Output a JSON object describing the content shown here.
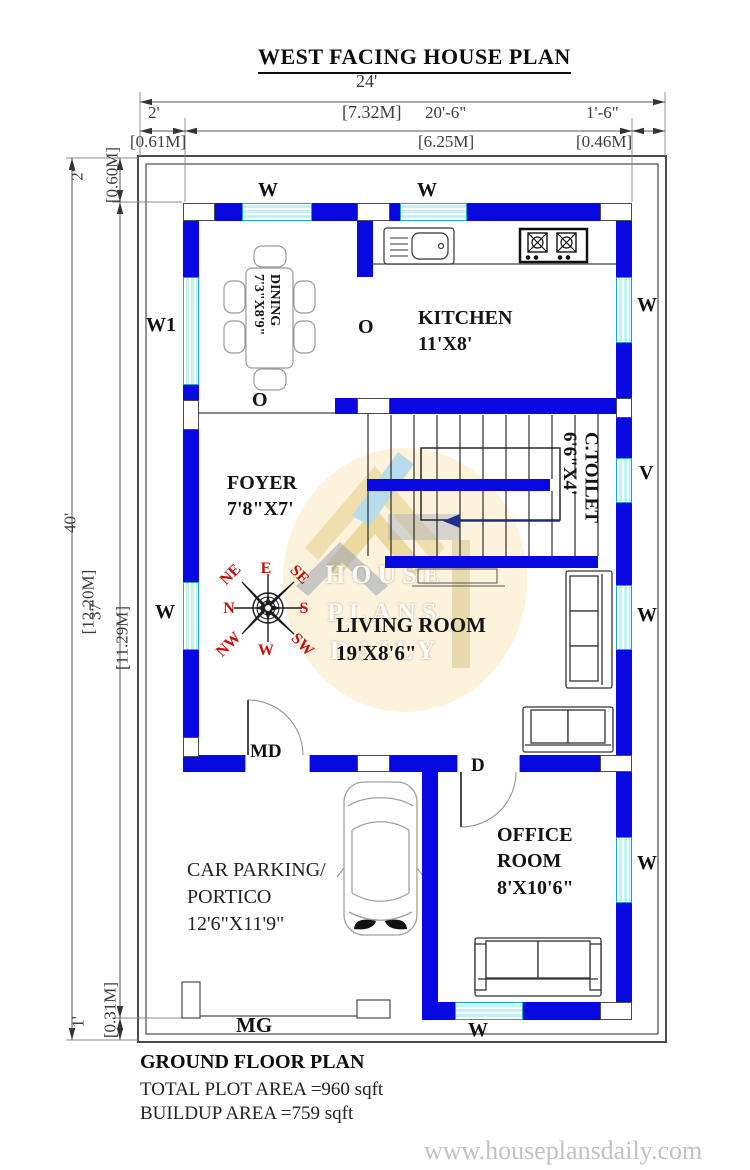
{
  "title": "WEST FACING HOUSE PLAN",
  "dimensions": {
    "top": {
      "overall_ft": "24'",
      "overall_m": "[7.32M]",
      "left_ft": "2'",
      "left_m": "[0.61M]",
      "mid_ft": "20'-6\"",
      "mid_m": "[6.25M]",
      "right_ft": "1'-6\"",
      "right_m": "[0.46M]"
    },
    "left": {
      "overall_ft": "40'",
      "overall_m": "[12.20M]",
      "top_ft": "2'",
      "top_m": "[0.60M]",
      "mid_ft": "37'",
      "mid_m": "[11.29M]",
      "bottom_ft": "1'",
      "bottom_m": "[0.31M]"
    }
  },
  "rooms": {
    "dining": {
      "name": "DINING",
      "size": "7'3\"X8'9\""
    },
    "kitchen": {
      "name": "KITCHEN",
      "size": "11'X8'"
    },
    "foyer": {
      "name": "FOYER",
      "size": "7'8\"X7'"
    },
    "ctoilet": {
      "name": "C.TOILET",
      "size": "6'6\"X4'"
    },
    "living": {
      "name": "LIVING ROOM",
      "size": "19'X8'6\""
    },
    "parking": {
      "line1": "CAR PARKING/",
      "line2": "PORTICO",
      "size": "12'6\"X11'9\""
    },
    "office": {
      "line1": "OFFICE",
      "line2": "ROOM",
      "size": "8'X10'6\""
    }
  },
  "openings": {
    "window": "W",
    "window1": "W1",
    "ventilator": "V",
    "opening": "O",
    "main_door": "MD",
    "door": "D",
    "main_gate": "MG"
  },
  "compass": {
    "e": "E",
    "se": "SE",
    "s": "S",
    "sw": "SW",
    "w": "W",
    "nw": "NW",
    "n": "N",
    "ne": "NE"
  },
  "watermark": {
    "line1": "HOUSE",
    "line2": "PLANS",
    "line3": "DAILY"
  },
  "footer": {
    "heading": "GROUND FLOOR PLAN",
    "plot_area": "TOTAL PLOT AREA =960 sqft",
    "buildup_area": "BUILDUP AREA =759 sqft",
    "website": "www.houseplansdaily.com"
  },
  "colors": {
    "wall": "#0808e0",
    "window_fill": "#c2f3f7",
    "window_border": "#1fa9bd",
    "compass_text": "#c40f0f",
    "watermark_bg": "#fdf3dc",
    "website_text": "#c6bfc4"
  }
}
